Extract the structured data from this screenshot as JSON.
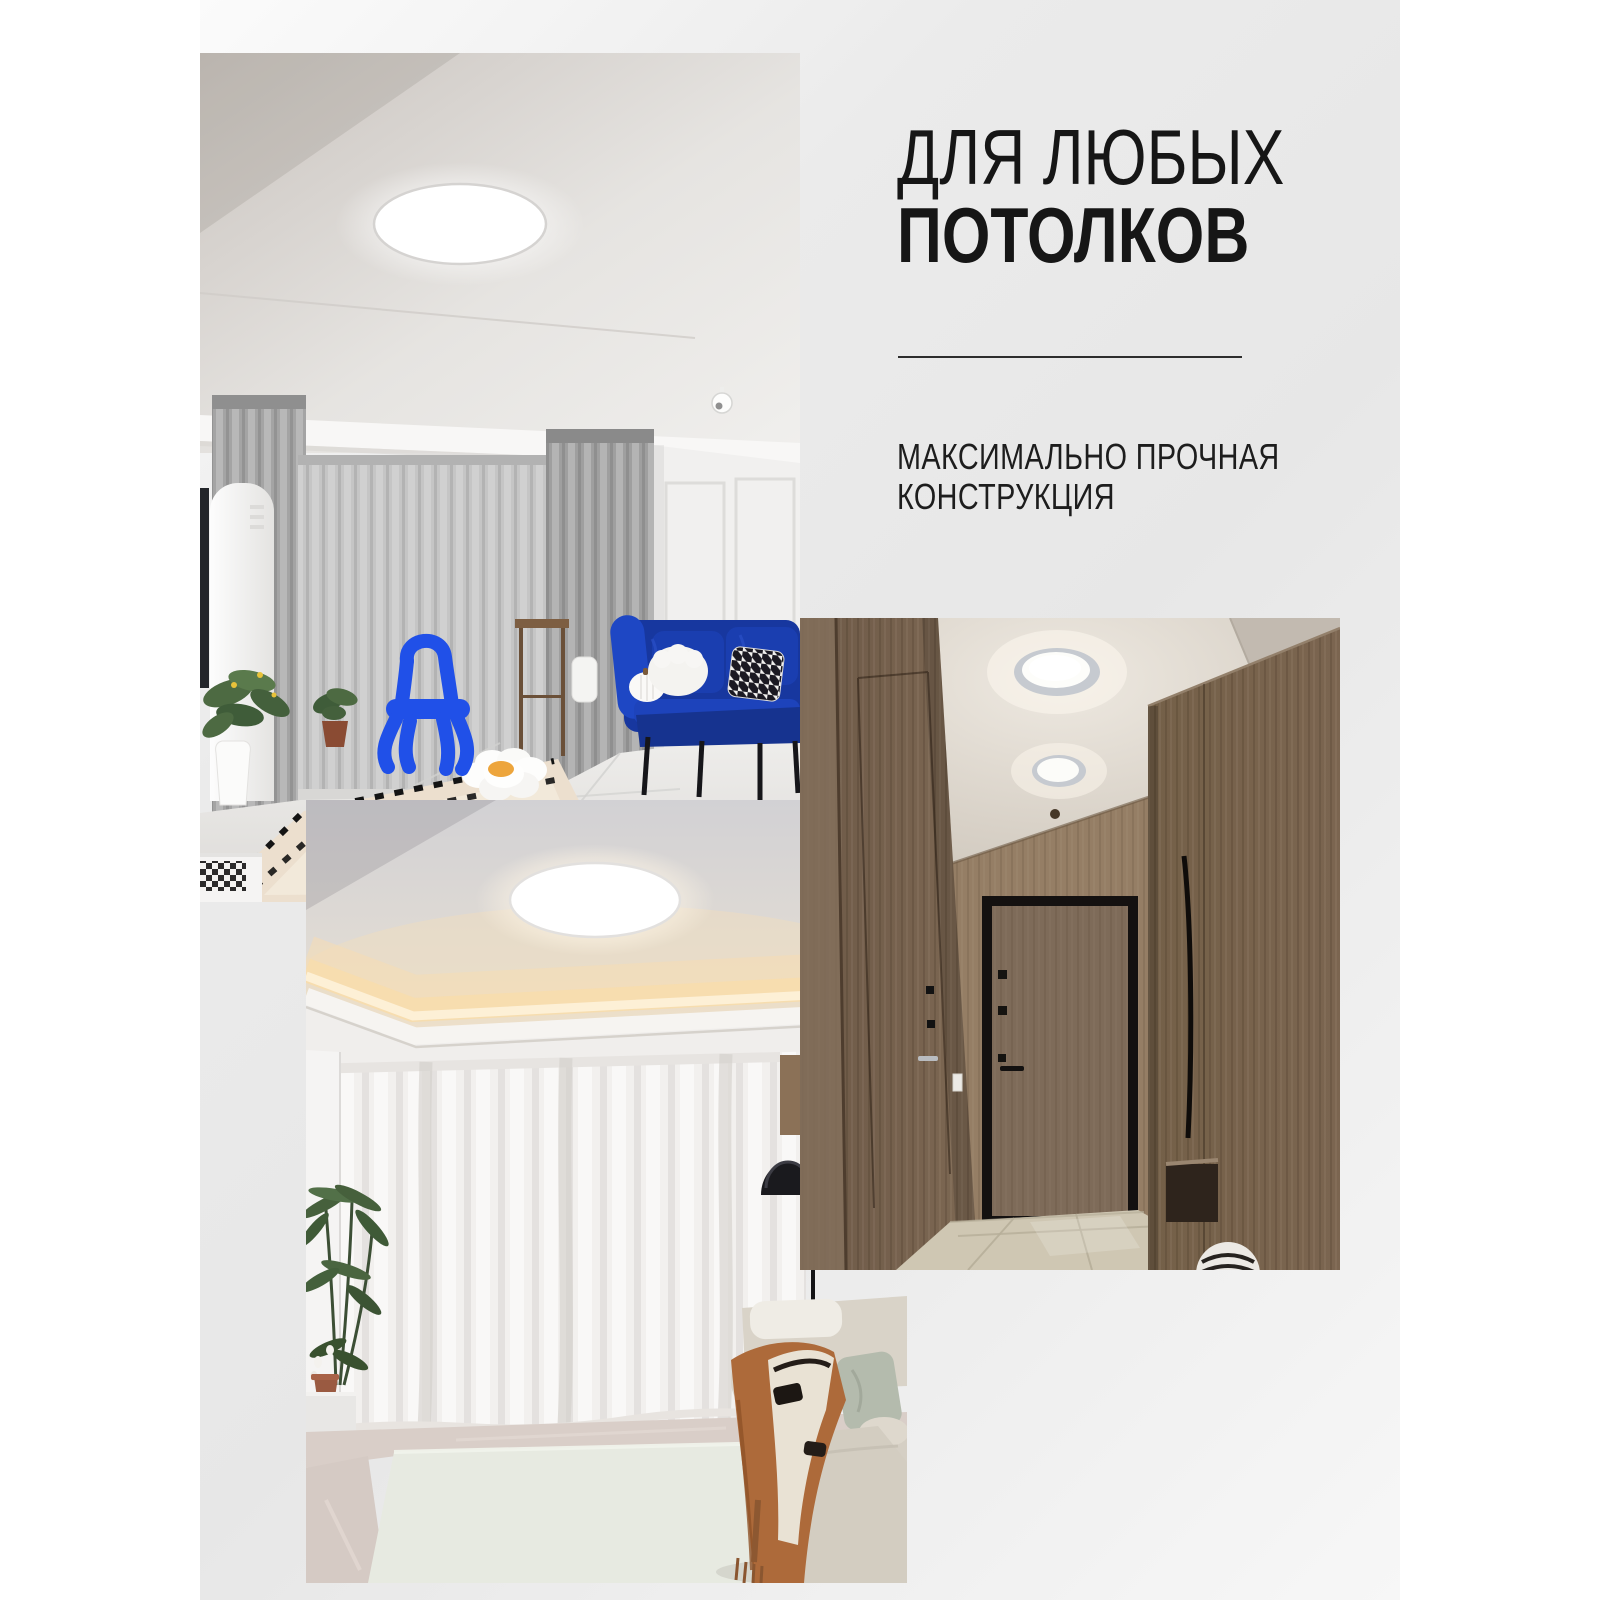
{
  "banner": {
    "headline": {
      "line1": "ДЛЯ ЛЮБЫХ",
      "line2": "ПОТОЛКОВ"
    },
    "subtitle": {
      "line1": "МАКСИМАЛЬНО ПРОЧНАЯ",
      "line2": "КОНСТРУКЦИЯ"
    }
  },
  "photos": [
    {
      "id": "living-room",
      "alt": "Гостиная с серыми шторами, синим диваном и круглым белым потолочным светильником"
    },
    {
      "id": "cove-ceiling-room",
      "alt": "Комната с белыми шторами, тёплой контурной подсветкой потолка и круглым светильником"
    },
    {
      "id": "hallway",
      "alt": "Деревянная прихожая с двумя круглыми потолочными светильниками"
    }
  ],
  "palette": {
    "page_bg": "#ffffff",
    "ink": "#161616",
    "divider": "#2d2d2d",
    "card_light": "#fbfbfb",
    "card_gray": "#e7e7e7",
    "warm_glow": "#f6dcb2",
    "sofa_blue": "#17379f",
    "chair_blue": "#2050e8",
    "wood_dark": "#6d5947",
    "wood_mid": "#7b6550",
    "carpet_sage": "#e7eae1",
    "blanket_rust": "#ad6a3a"
  }
}
